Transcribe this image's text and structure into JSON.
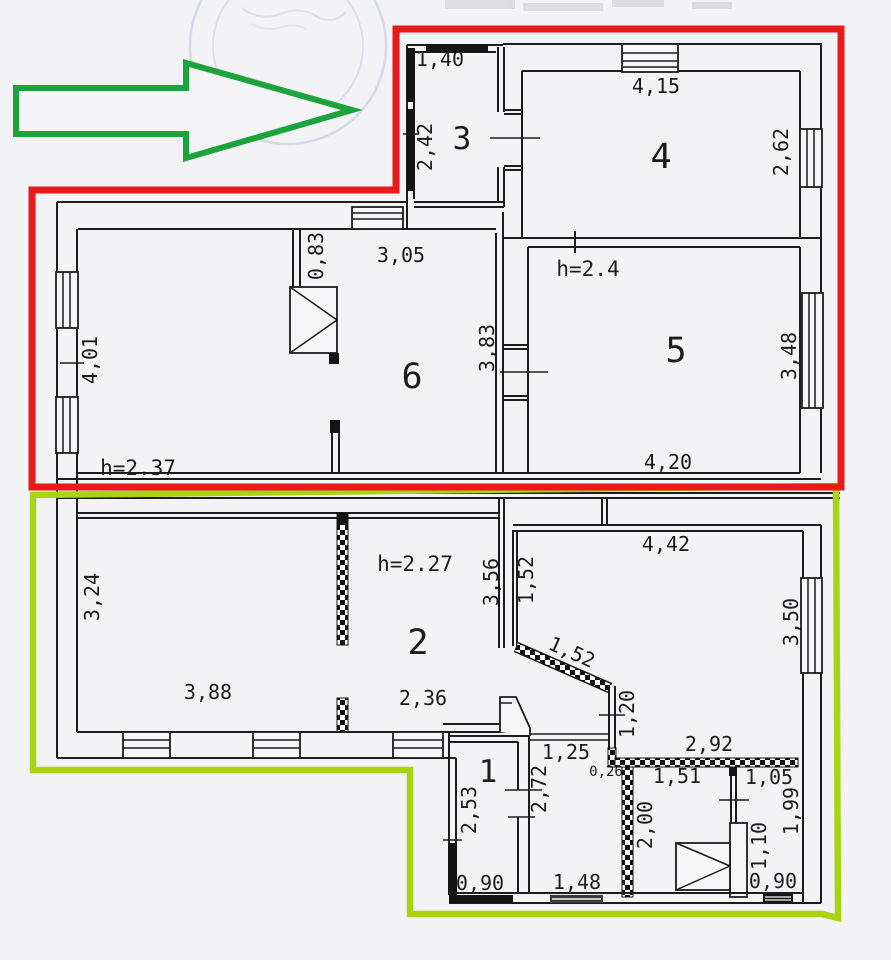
{
  "annotations": {
    "arrow_color": "#1da33c",
    "upper_outline_color": "#e81a1a",
    "lower_outline_color": "#a8d414"
  },
  "upper_unit": {
    "height_label": "h=2.37",
    "room3": {
      "number": "3",
      "width_top": "1,40",
      "height_left": "2,42"
    },
    "room4": {
      "number": "4",
      "width_top": "4,15",
      "height_right": "2,62"
    },
    "room5": {
      "number": "5",
      "height_label": "h=2.4",
      "width_bottom": "4,20",
      "height_right": "3,48",
      "height_left": "3,83"
    },
    "room6": {
      "number": "6",
      "width_top": "3,05",
      "stub_height": "0,83",
      "height_left": "4,01"
    }
  },
  "lower_unit": {
    "height_label": "h=2.27",
    "room2": {
      "number": "2",
      "width_bottom": "2,36",
      "height_right": "3,56"
    },
    "west_room": {
      "height_left": "3,24",
      "width_bottom": "3,88"
    },
    "northeast_room": {
      "width_top": "4,42",
      "height_right": "3,50",
      "height_left": "1,52",
      "diagonal_wall": "1,52"
    },
    "room1": {
      "number": "1",
      "height_left": "2,53",
      "height_right": "2,72",
      "width_bottom": "0,90",
      "opening_top": "1,25"
    },
    "hallway": {
      "width_bottom": "1,48",
      "wall_height": "1,20",
      "wall_offset": "0,26"
    },
    "pantry": {
      "width_top": "1,51",
      "height_left": "2,00",
      "wall_top": "2,92"
    },
    "bathroom": {
      "width_top": "1,05",
      "height_right": "1,99",
      "wall_inner": "1,10",
      "width_bottom": "0,90"
    }
  }
}
